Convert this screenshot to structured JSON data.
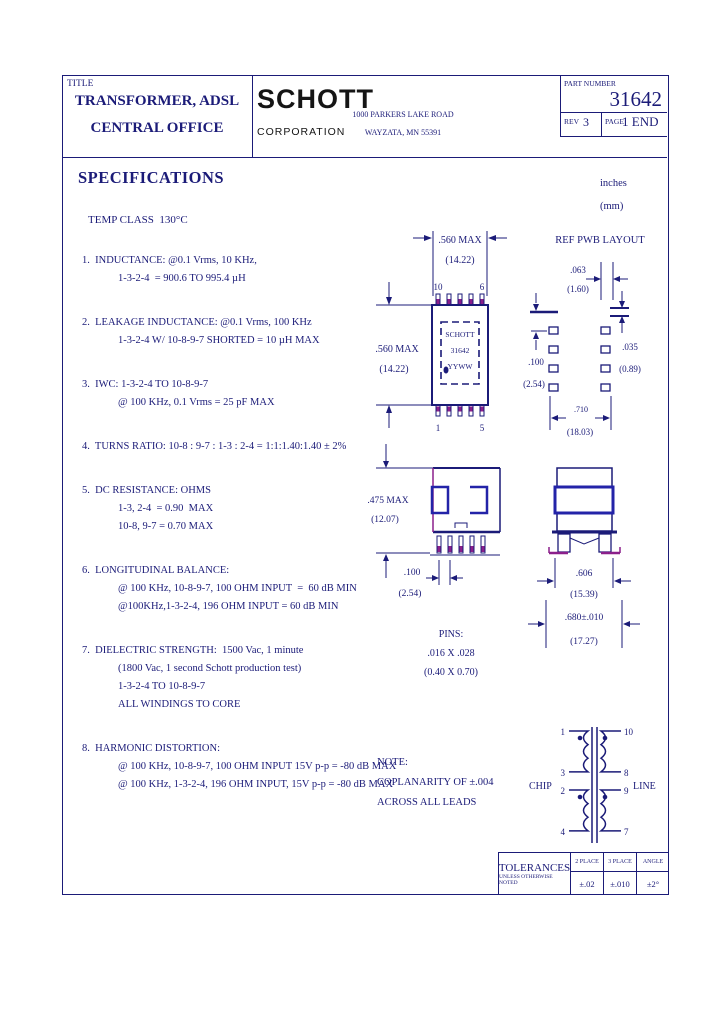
{
  "header": {
    "title_label": "TITLE",
    "title_line1": "TRANSFORMER, ADSL",
    "title_line2": "CENTRAL OFFICE",
    "company": "SCHOTT",
    "company_sub": "CORPORATION",
    "address1": "1000 PARKERS LAKE ROAD",
    "address2": "WAYZATA, MN 55391",
    "part_number_label": "PART NUMBER",
    "part_number": "31642",
    "rev_label": "REV",
    "rev": "3",
    "page_label": "PAGE",
    "page": "1 END"
  },
  "units": {
    "inches": "inches",
    "mm": "(mm)"
  },
  "specs": {
    "heading": "SPECIFICATIONS",
    "temp_class": "TEMP CLASS  130°C",
    "items": [
      {
        "lines": [
          "1.  INDUCTANCE: @0.1 Vrms, 10 KHz,",
          "1-3-2-4  = 900.6 TO 995.4 µH"
        ]
      },
      {
        "lines": [
          "2.  LEAKAGE INDUCTANCE: @0.1 Vrms, 100 KHz",
          "1-3-2-4 W/ 10-8-9-7 SHORTED = 10 µH MAX"
        ]
      },
      {
        "lines": [
          "3.  IWC: 1-3-2-4 TO 10-8-9-7",
          "@ 100 KHz, 0.1 Vrms = 25 pF MAX"
        ]
      },
      {
        "lines": [
          "4.  TURNS RATIO: 10-8 : 9-7 : 1-3 : 2-4 = 1:1:1.40:1.40 ± 2%"
        ]
      },
      {
        "lines": [
          "5.  DC RESISTANCE: OHMS",
          "1-3, 2-4  = 0.90  MAX",
          "10-8, 9-7 = 0.70 MAX"
        ]
      },
      {
        "lines": [
          "6.  LONGITUDINAL BALANCE:",
          "@ 100 KHz, 10-8-9-7, 100 OHM INPUT  =  60 dB MIN",
          "@100KHz,1-3-2-4, 196 OHM INPUT = 60 dB MIN"
        ]
      },
      {
        "lines": [
          "7.  DIELECTRIC STRENGTH:  1500 Vac, 1 minute",
          "(1800 Vac, 1 second Schott production test)",
          "1-3-2-4 TO 10-8-9-7",
          "ALL WINDINGS TO CORE"
        ]
      },
      {
        "lines": [
          "8.  HARMONIC DISTORTION:",
          "@ 100 KHz, 10-8-9-7, 100 OHM INPUT 15V p-p = -80 dB MAX",
          "@ 100 KHz, 1-3-2-4, 196 OHM INPUT, 15V p-p = -80 dB MAX"
        ]
      }
    ]
  },
  "top_view": {
    "dim_w": ".560 MAX",
    "dim_w_mm": "(14.22)",
    "dim_h": ".560 MAX",
    "dim_h_mm": "(14.22)",
    "pin_tl": "10",
    "pin_tr": "6",
    "pin_bl": "1",
    "pin_br": "5",
    "mark1": "SCHOTT",
    "mark2": "31642",
    "mark3": "YYWW"
  },
  "pwb": {
    "heading": "REF PWB LAYOUT",
    "dim_pad_w": ".063",
    "dim_pad_w_mm": "(1.60)",
    "dim_pad_h": ".035",
    "dim_pad_h_mm": "(0.89)",
    "dim_pitch": ".100",
    "dim_pitch_mm": "(2.54)",
    "dim_span": ".710",
    "dim_span_mm": "(18.03)"
  },
  "side_view": {
    "dim_h": ".475 MAX",
    "dim_h_mm": "(12.07)",
    "dim_pitch": ".100",
    "dim_pitch_mm": "(2.54)"
  },
  "end_view": {
    "dim_body": ".606",
    "dim_body_mm": "(15.39)",
    "dim_lead": ".680±.010",
    "dim_lead_mm": "(17.27)"
  },
  "pins_note": {
    "l1": "PINS:",
    "l2": ".016 X .028",
    "l3": "(0.40 X 0.70)"
  },
  "note": {
    "l1": "NOTE:",
    "l2": "COPLANARITY OF ±.004",
    "l3": "ACROSS ALL LEADS"
  },
  "schematic": {
    "chip": "CHIP",
    "line": "LINE",
    "pins_left": [
      "1",
      "3",
      "2",
      "4"
    ],
    "pins_right": [
      "10",
      "8",
      "9",
      "7"
    ]
  },
  "tolerances": {
    "heading": "TOLERANCES",
    "sub": "UNLESS OTHERWISE NOTED",
    "cols": [
      {
        "label": "2 PLACE",
        "value": "±.02"
      },
      {
        "label": "3 PLACE",
        "value": "±.010"
      },
      {
        "label": "ANGLE",
        "value": "±2°"
      }
    ]
  }
}
